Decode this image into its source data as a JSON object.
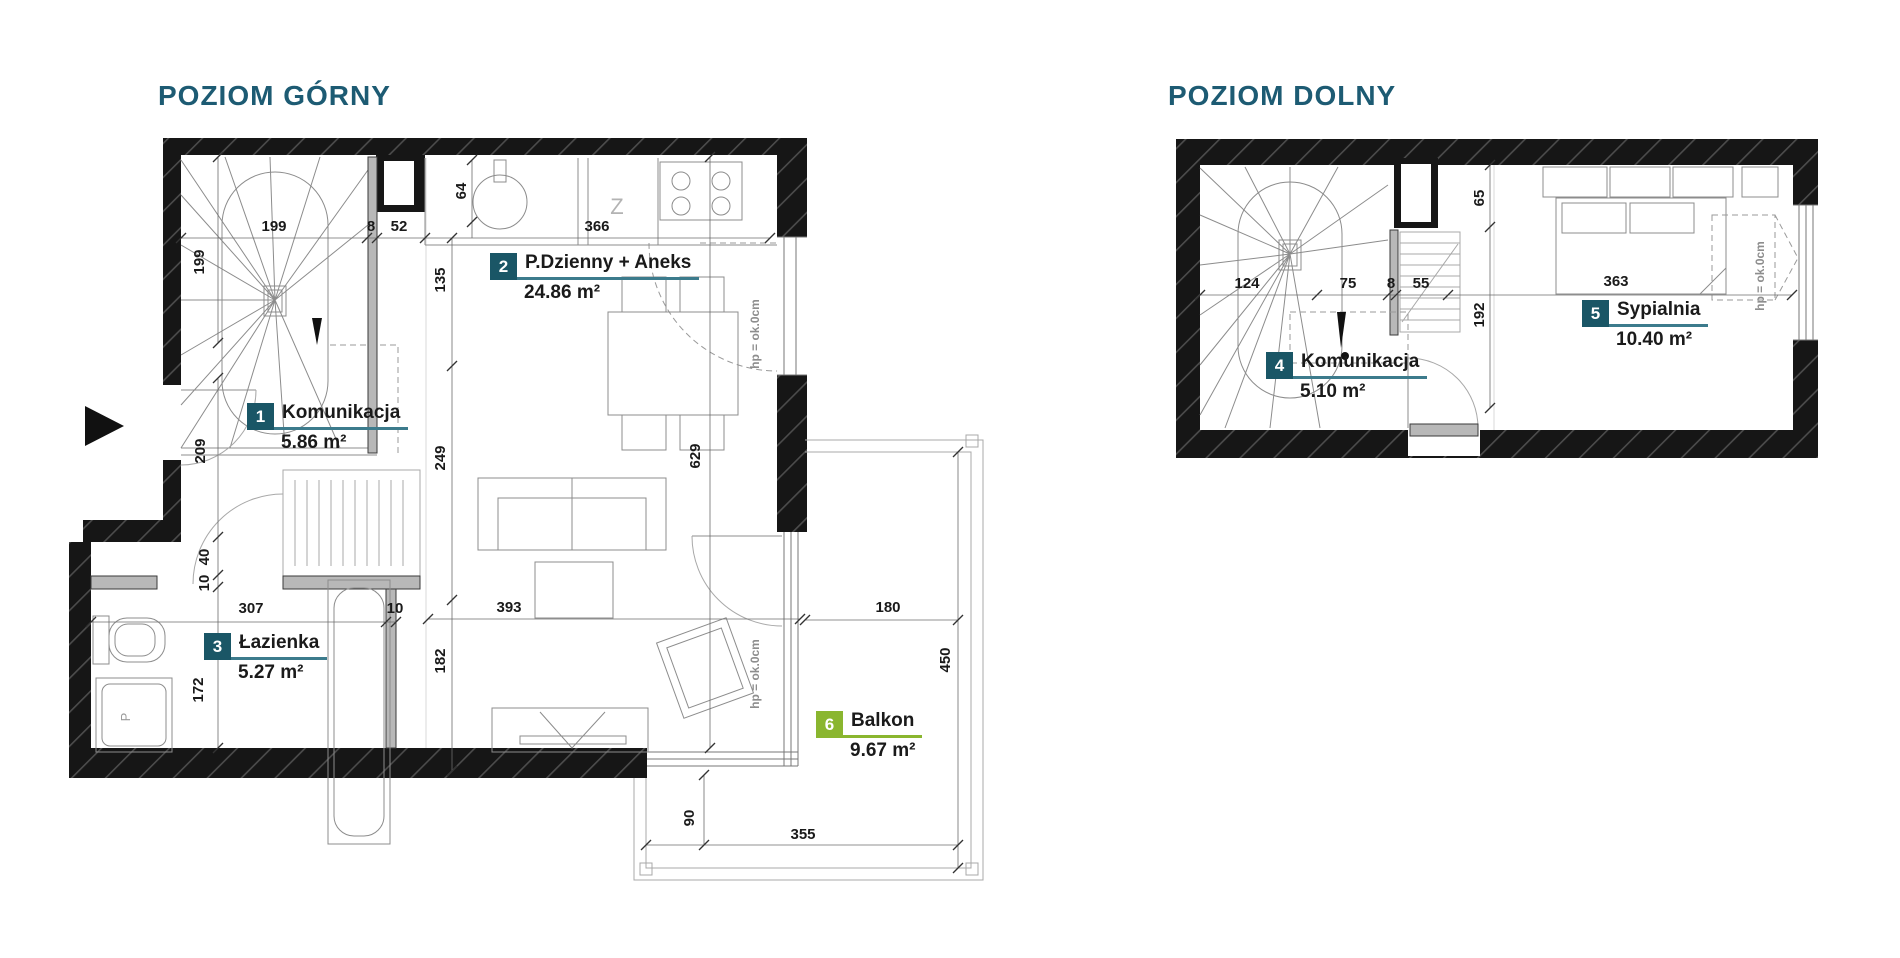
{
  "upper": {
    "title": "POZIOM GÓRNY",
    "rooms": [
      {
        "num": "1",
        "name": "Komunikacja",
        "area": "5.86 m²"
      },
      {
        "num": "2",
        "name": "P.Dzienny + Aneks",
        "area": "24.86 m²"
      },
      {
        "num": "3",
        "name": "Łazienka",
        "area": "5.27 m²"
      },
      {
        "num": "6",
        "name": "Balkon",
        "area": "9.67 m²"
      }
    ],
    "dims": {
      "d199a": "199",
      "d199b": "199",
      "d8": "8",
      "d52": "52",
      "d64": "64",
      "d366": "366",
      "d135": "135",
      "d249": "249",
      "d629": "629",
      "d209": "209",
      "d40": "40",
      "d10a": "10",
      "d307": "307",
      "d10b": "10",
      "d393": "393",
      "d182": "182",
      "d172": "172",
      "d180": "180",
      "d450": "450",
      "d355": "355",
      "d90": "90"
    },
    "annotations": {
      "hp": "hp = ok.0cm",
      "kitchen_z": "Z",
      "washer_p": "P"
    }
  },
  "lower": {
    "title": "POZIOM DOLNY",
    "rooms": [
      {
        "num": "4",
        "name": "Komunikacja",
        "area": "5.10 m²"
      },
      {
        "num": "5",
        "name": "Sypialnia",
        "area": "10.40 m²"
      }
    ],
    "dims": {
      "d124": "124",
      "d75": "75",
      "d8": "8",
      "d55": "55",
      "d65": "65",
      "d192": "192",
      "d363": "363"
    },
    "annotations": {
      "hp": "hp = ok.0cm"
    }
  },
  "colors": {
    "title": "#1d5b73",
    "badge_teal": "#1a5666",
    "badge_green": "#8ab62f",
    "underline_teal": "#3c7b8c",
    "wall": "#161616"
  }
}
